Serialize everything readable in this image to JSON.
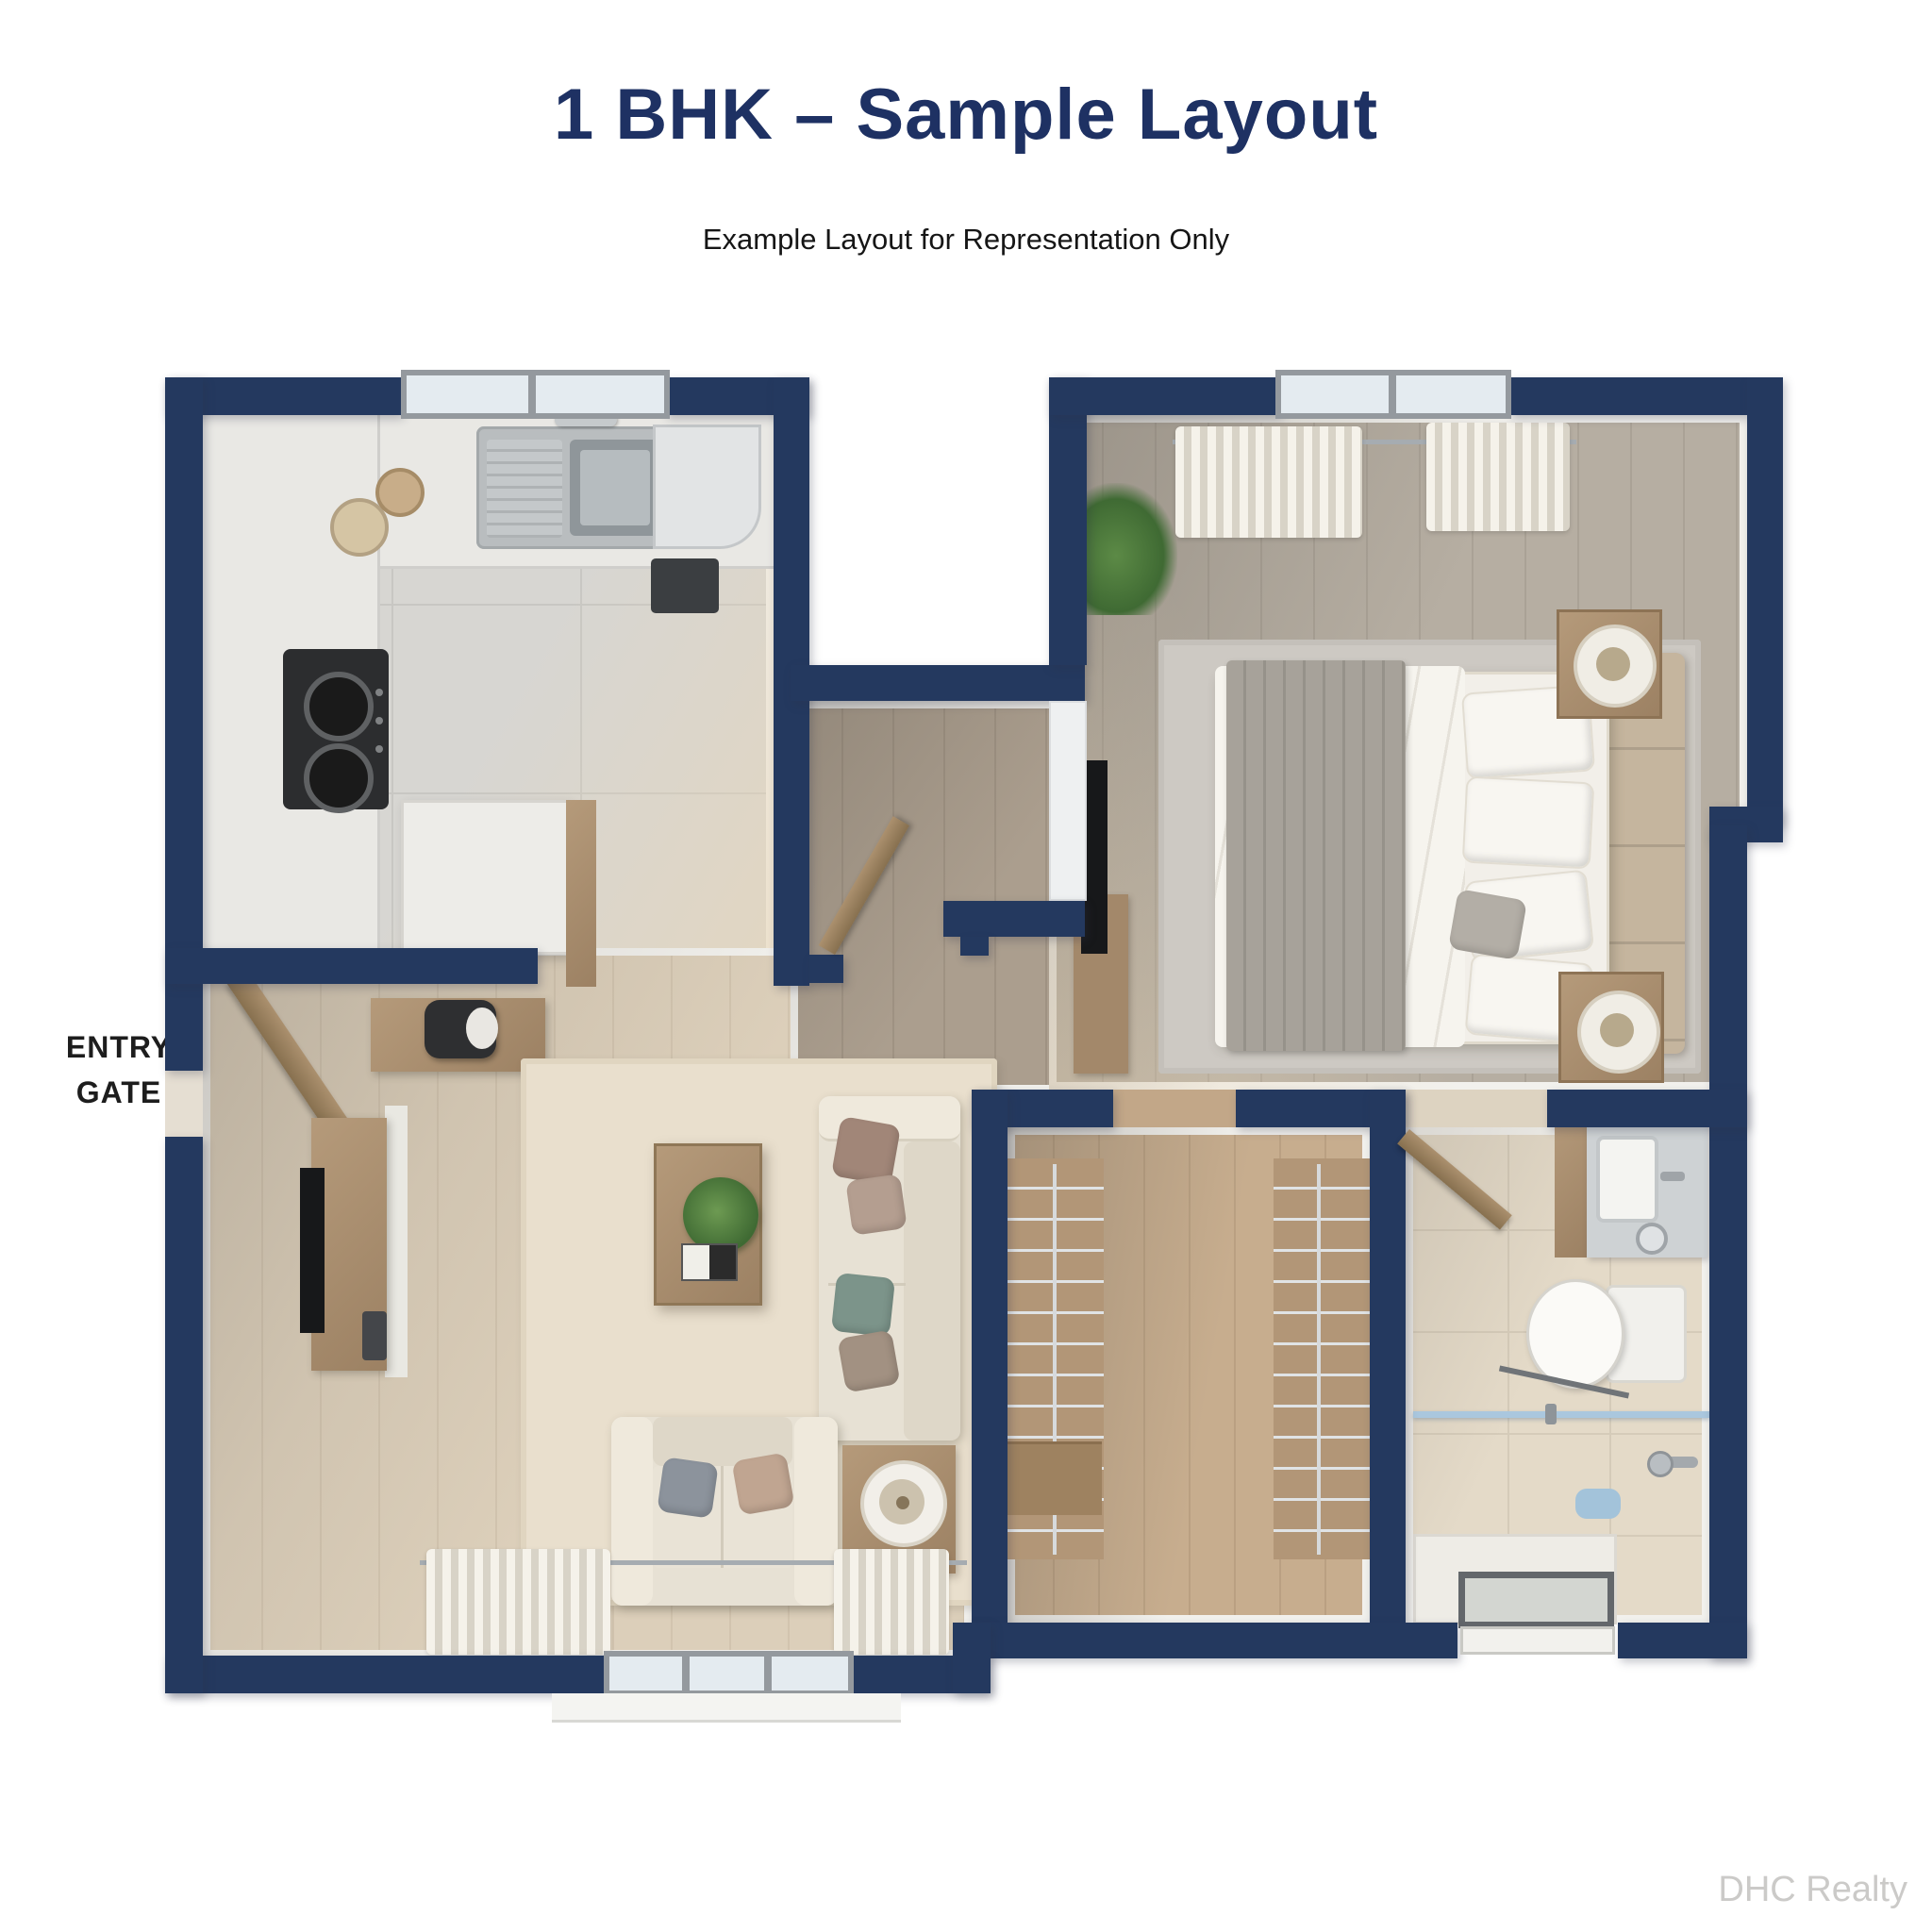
{
  "header": {
    "title": "1 BHK – Sample Layout",
    "subtitle": "Example Layout for Representation Only"
  },
  "entry_gate": {
    "line1": "ENTRY",
    "line2": "GATE"
  },
  "watermark": "DHC Realty",
  "colors": {
    "wall_navy": "#24395f",
    "title_navy": "#1e3163",
    "subtitle_black": "#161616",
    "watermark_gray": "#cbcac8",
    "glass_blue": "#aac7de"
  }
}
